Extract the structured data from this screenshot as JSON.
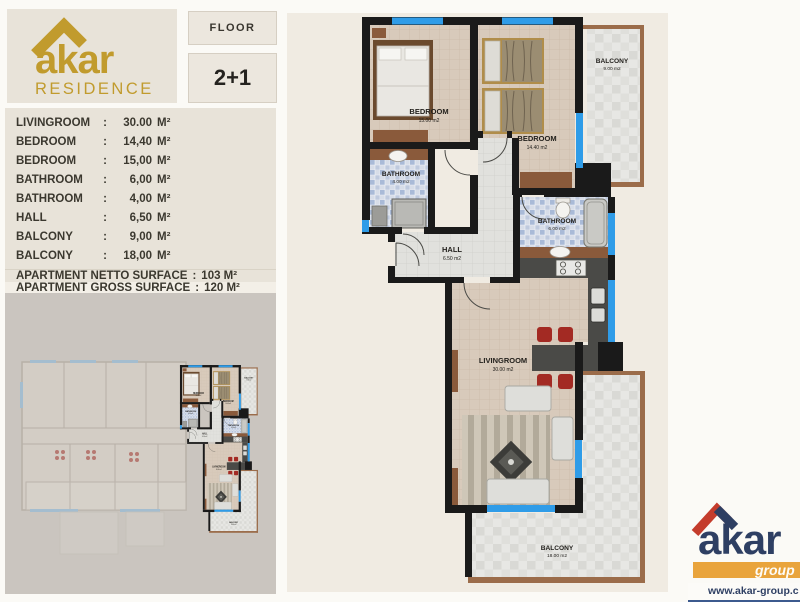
{
  "brand": {
    "name": "akar",
    "subtitle": "RESIDENCE"
  },
  "header": {
    "floor_label": "FLOOR",
    "unit_type": "2+1"
  },
  "room_list": {
    "colon": ":",
    "rows": [
      {
        "name": "LIVINGROOM",
        "value": "30.00",
        "unit": "M²"
      },
      {
        "name": "BEDROOM",
        "value": "14,40",
        "unit": "M²"
      },
      {
        "name": "BEDROOM",
        "value": "15,00",
        "unit": "M²"
      },
      {
        "name": "BATHROOM",
        "value": "6,00",
        "unit": "M²"
      },
      {
        "name": "BATHROOM",
        "value": "4,00",
        "unit": "M²"
      },
      {
        "name": "HALL",
        "value": "6,50",
        "unit": "M²"
      },
      {
        "name": "BALCONY",
        "value": "9,00",
        "unit": "M²"
      },
      {
        "name": "BALCONY",
        "value": "18,00",
        "unit": "M²"
      }
    ]
  },
  "summary": {
    "netto_label": "APARTMENT NETTO SURFACE",
    "netto_sep": ":",
    "netto_value": "103 M²",
    "gross_label": "APARTMENT GROSS SURFACE",
    "gross_sep": ":",
    "gross_value": "120 M²"
  },
  "plan": {
    "bedroom_a": {
      "name": "BEDROOM",
      "area": "15.00 m2"
    },
    "bedroom_b": {
      "name": "BEDROOM",
      "area": "14.40 m2"
    },
    "bathroom_small": {
      "name": "BATHROOM",
      "area": "4.00 m2"
    },
    "bathroom_big": {
      "name": "BATHROOM",
      "area": "6.00 m2"
    },
    "hall": {
      "name": "HALL",
      "area": "6.50 m2"
    },
    "livingroom": {
      "name": "LIVINGROOM",
      "area": "30.00 m2"
    },
    "balcony_top": {
      "name": "BALCONY",
      "area": "9.00 m2"
    },
    "balcony_bottom": {
      "name": "BALCONY",
      "area": "18.00 m2"
    }
  },
  "footer": {
    "brand": "akar",
    "group": "group",
    "website": "www.akar-group.c"
  },
  "colors": {
    "gold": "#c19b2d",
    "navy": "#2e3f63",
    "red": "#c43c2c",
    "orange": "#e9a43c",
    "window_blue": "#2f9ce8",
    "wall": "#1a1a1a"
  }
}
